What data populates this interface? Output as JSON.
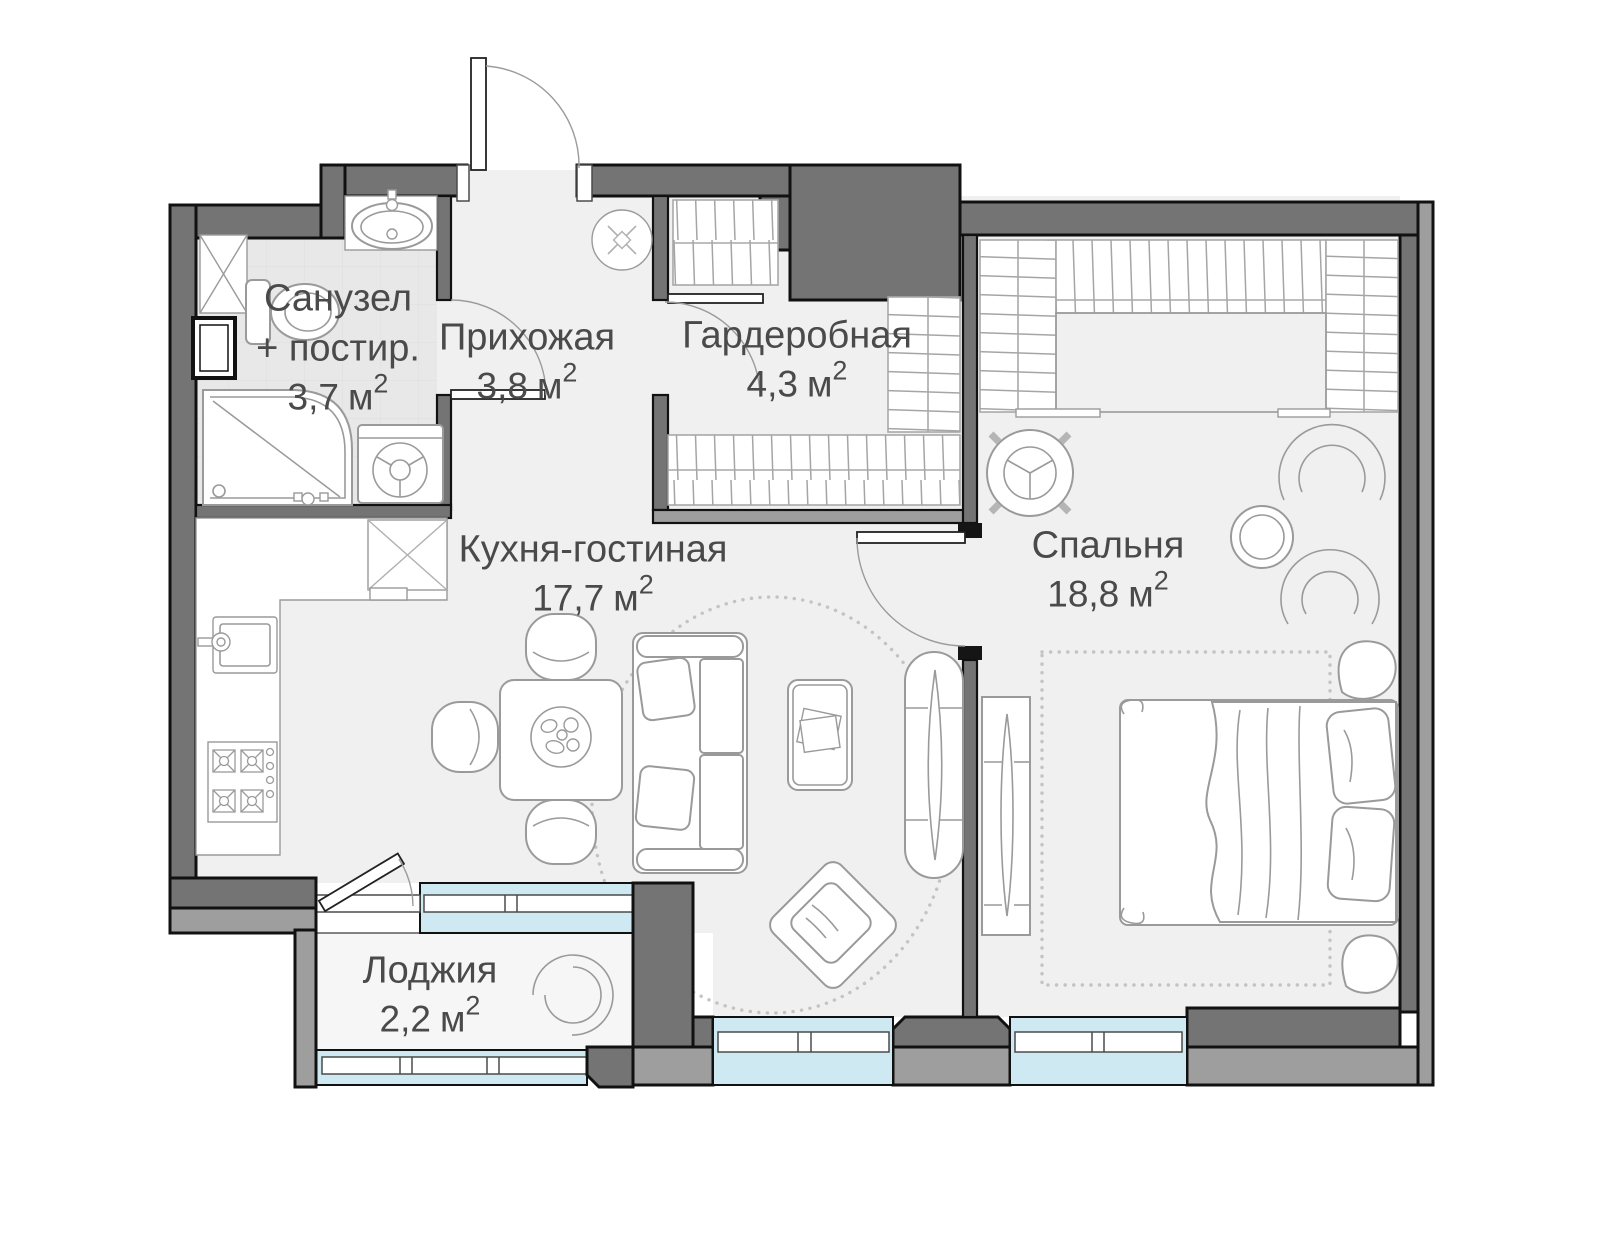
{
  "floor_plan": {
    "rooms": [
      {
        "id": "bathroom",
        "name_line1": "Санузел",
        "name_line2": "+ постир.",
        "area_value": "3,7",
        "area_unit": "м",
        "area_sup": "2"
      },
      {
        "id": "hallway",
        "name_line1": "Прихожая",
        "area_value": "3,8",
        "area_unit": "м",
        "area_sup": "2"
      },
      {
        "id": "wardrobe-room",
        "name_line1": "Гардеробная",
        "area_value": "4,3",
        "area_unit": "м",
        "area_sup": "2"
      },
      {
        "id": "kitchen-living",
        "name_line1": "Кухня-гостиная",
        "area_value": "17,7",
        "area_unit": "м",
        "area_sup": "2"
      },
      {
        "id": "bedroom",
        "name_line1": "Спальня",
        "area_value": "18,8",
        "area_unit": "м",
        "area_sup": "2"
      },
      {
        "id": "loggia",
        "name_line1": "Лоджия",
        "area_value": "2,2",
        "area_unit": "м",
        "area_sup": "2"
      }
    ],
    "fixtures": [
      "entrance-door",
      "bathroom-door",
      "wardrobe-door",
      "bedroom-door",
      "balcony-door",
      "toilet-icon",
      "bath-sink-icon",
      "shower-icon",
      "washing-machine-icon",
      "duct-shaft-icon",
      "kitchen-counter",
      "kitchen-sink-icon",
      "stove-icon",
      "fridge-icon",
      "vent-icon",
      "dining-table-icon",
      "dining-chair-icon",
      "sofa-icon",
      "coffee-table-icon",
      "ottoman-icon",
      "tv-console-icon",
      "bed-icon",
      "wardrobe-hatch",
      "side-table-icon",
      "armchair-icon",
      "pouf-icon",
      "rug",
      "loggia-chair-icon",
      "window"
    ],
    "colors": {
      "wall": "#747474",
      "wall-light": "#9e9e9e",
      "window": "#cfe9f3",
      "floor": "#f0f0f0",
      "floor-bath": "#e8e8e8",
      "floor-loggia": "#f6f6f6",
      "outline": "#111111",
      "furniture": "#9a9a9a",
      "text": "#4a4a4a"
    }
  }
}
